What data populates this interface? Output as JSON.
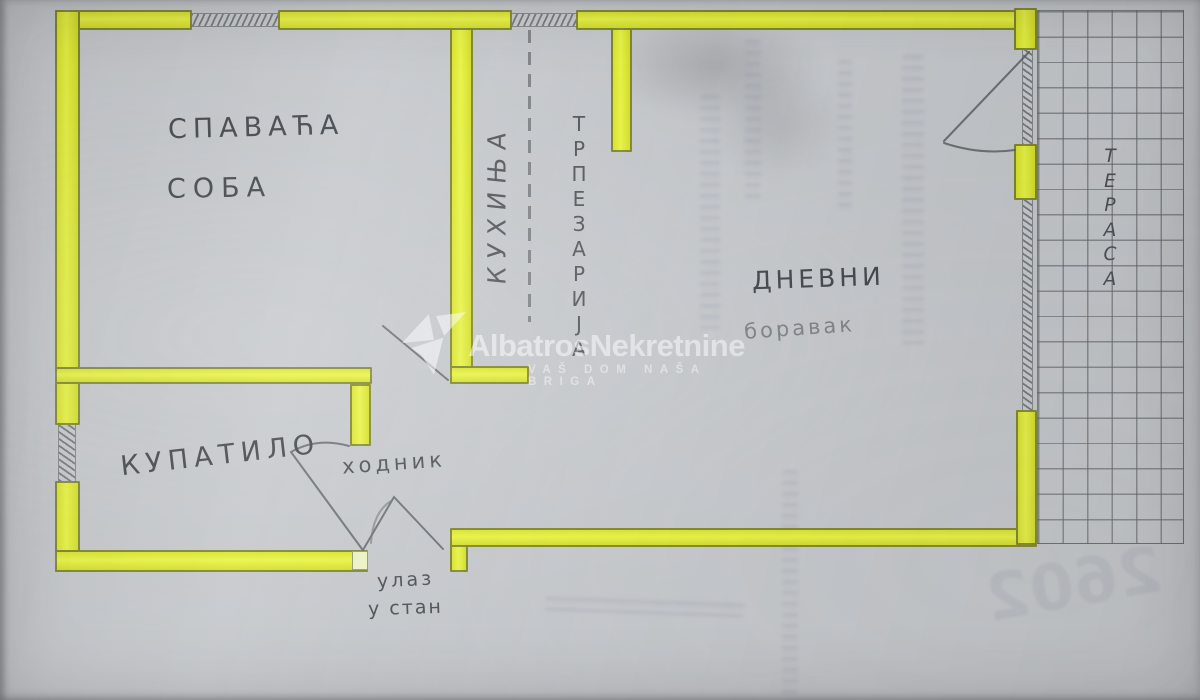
{
  "rooms": {
    "bedroom": {
      "line1": "СПАВАЋА",
      "line2": "СОБА"
    },
    "kitchen": {
      "label": "КУХИЊА"
    },
    "dining": {
      "label": "ТРПЕЗАРИЈА",
      "letters": [
        "Т",
        "Р",
        "П",
        "Е",
        "З",
        "А",
        "Р",
        "И",
        "Ј",
        "А"
      ]
    },
    "living": {
      "line1": "ДНЕВНИ",
      "line2": "боравак"
    },
    "bathroom": {
      "label": "КУПАТИЛО"
    },
    "hallway": {
      "label": "ходник"
    },
    "entrance": {
      "line1": "улаз",
      "line2": "у стан"
    },
    "terrace": {
      "label": "ТЕРАСА",
      "letters": [
        "Т",
        "Е",
        "Р",
        "А",
        "С",
        "А"
      ]
    }
  },
  "watermark": {
    "brand": "AlbatrosNekretnine",
    "tagline": "VAŠ DOM NAŠA BRIGA",
    "logo": "albatros-bird-logo",
    "color": "#ffffff"
  },
  "colors": {
    "wall_highlight": "#e4ef33",
    "paper": "#c6c9cd",
    "pencil": "#5f6367",
    "handwriting": "#45494e"
  },
  "artifacts": {
    "bleedthrough_number": "2602"
  }
}
